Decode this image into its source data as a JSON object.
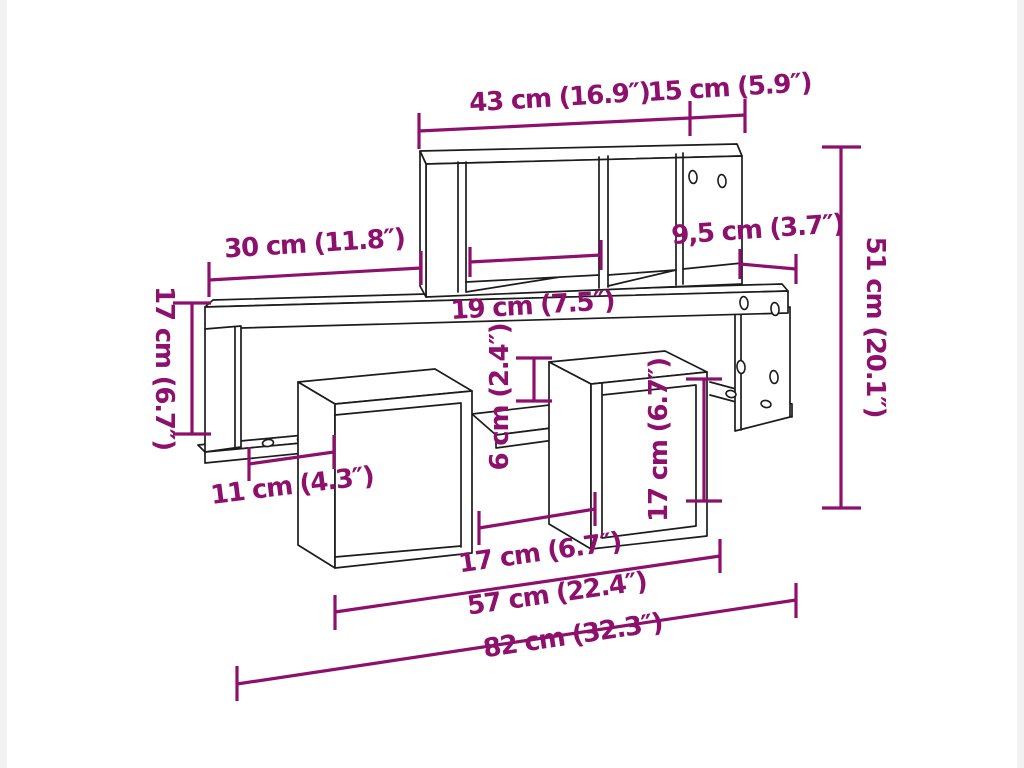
{
  "page": {
    "background_color": "#ffffff",
    "accent_color": "#8c106c",
    "line_color": "#1c1c1c",
    "content": "wall-shelf-dimension-diagram"
  },
  "diagram": {
    "product": "wall shelf with cube compartments",
    "units": "cm and inches",
    "dimensions": {
      "top_width": {
        "label": "43 cm (16.9″)",
        "value_cm": "43",
        "value_in": "16.9"
      },
      "top_depth": {
        "label": "15 cm (5.9″)",
        "value_cm": "15",
        "value_in": "5.9"
      },
      "upper_left_width": {
        "label": "30 cm (11.8″)",
        "value_cm": "30",
        "value_in": "11.8"
      },
      "right_depth": {
        "label": "9,5 cm (3.7″)",
        "value_cm": "9,5",
        "value_in": "3.7"
      },
      "middle_width": {
        "label": "19 cm (7.5″)",
        "value_cm": "19",
        "value_in": "7.5"
      },
      "total_height": {
        "label": "51 cm (20.1″)",
        "value_cm": "51",
        "value_in": "20.1"
      },
      "left_height": {
        "label": "17 cm (6.7″)",
        "value_cm": "17",
        "value_in": "6.7"
      },
      "opening_height": {
        "label": "6 cm (2.4″)",
        "value_cm": "6",
        "value_in": "2.4"
      },
      "cube_height": {
        "label": "17 cm (6.7″)",
        "value_cm": "17",
        "value_in": "6.7"
      },
      "left_board_width": {
        "label": "11 cm (4.3″)",
        "value_cm": "11",
        "value_in": "4.3"
      },
      "bottom_gap_width": {
        "label": "17 cm (6.7″)",
        "value_cm": "17",
        "value_in": "6.7"
      },
      "lower_width": {
        "label": "57 cm (22.4″)",
        "value_cm": "57",
        "value_in": "22.4"
      },
      "total_width": {
        "label": "82 cm (32.3″)",
        "value_cm": "82",
        "value_in": "32.3"
      }
    }
  }
}
